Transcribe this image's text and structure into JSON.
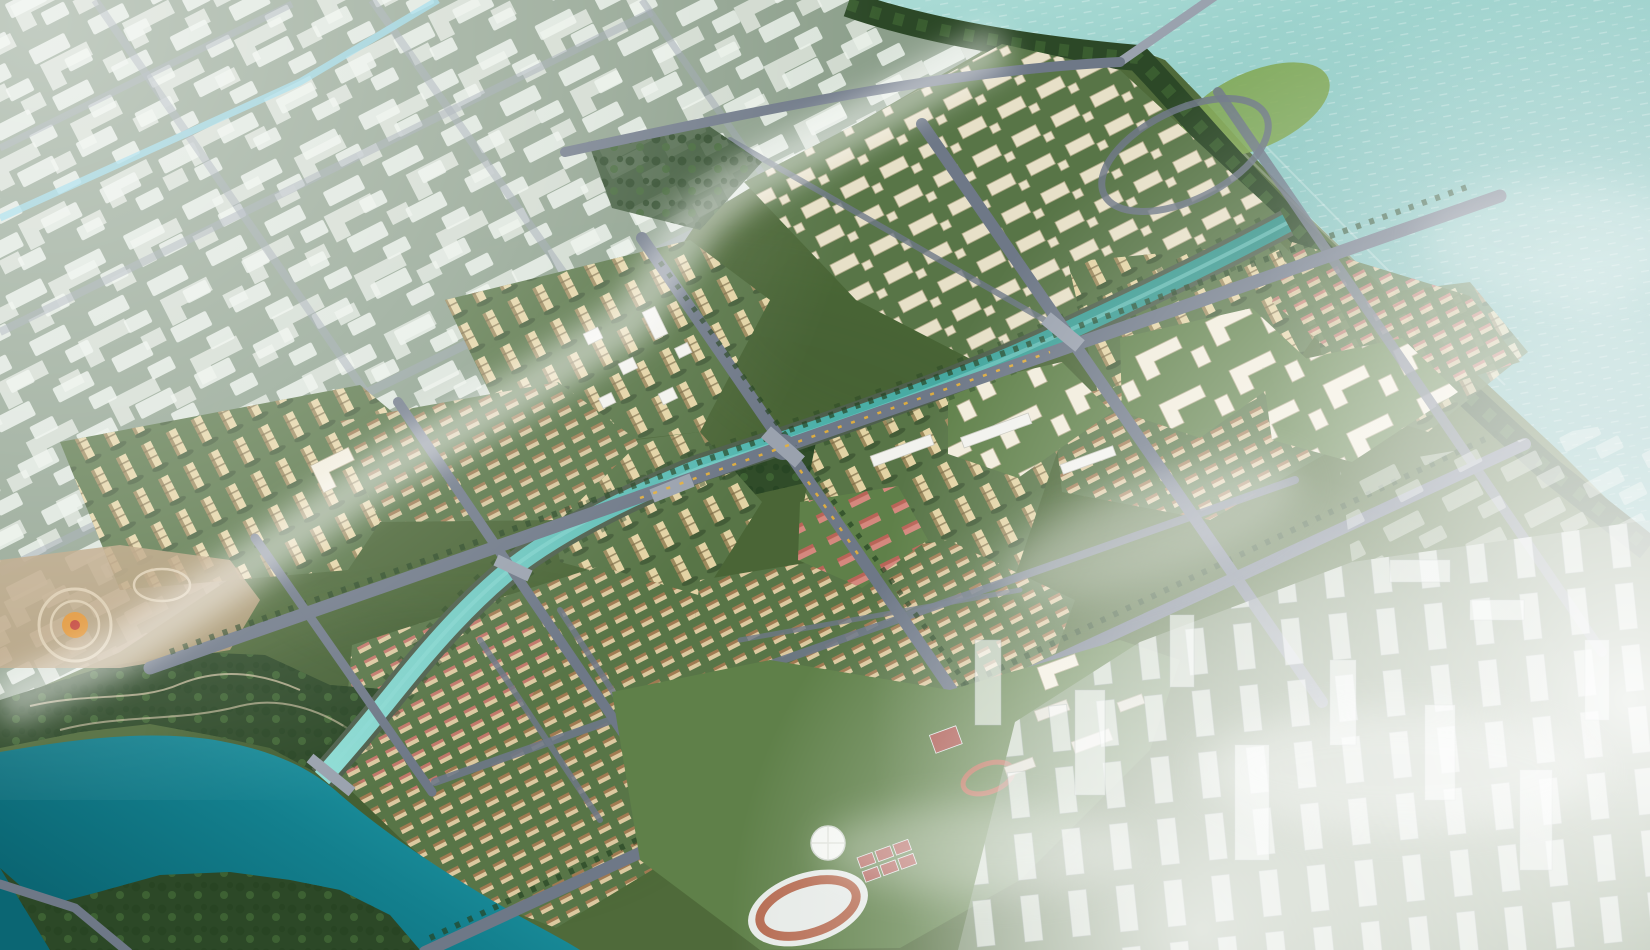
{
  "meta": {
    "title": "Aerial rendering of a waterfront urban master plan",
    "description": "Bird's-eye architectural visualization: a fully rendered residential district with gold high-rise clusters, villa rows, canals and a boulevard grid occupies the center; a ghosted white future-phase block district fades out at the upper left; a teal sea with a causeway bridge lies at the upper right behind a coastal tree belt; a winding river with forest park and a circular plaza garden sits at the lower left; a sports campus with stadium, dome and courts sits at the bottom center; ghosted CBD towers dissolve into white fog at the lower right."
  },
  "features": [
    "sea-with-sparkle",
    "coastal-tree-belt",
    "causeway-bridge",
    "lawn-hill",
    "ghost-phase-district",
    "ghost-district-canal",
    "central-canal",
    "winding-river",
    "riverside-forest-park",
    "circular-plaza-garden",
    "tower-clusters",
    "courtyard-lowrise-district",
    "villa-rows",
    "townhouse-rows",
    "school-campuses",
    "pink-school-buildings",
    "white-commercial-midrises",
    "sports-campus",
    "stadium-running-track",
    "geodesic-dome",
    "tennis-courts",
    "ghost-cbd-towers",
    "boulevard-grid-with-tree-lines",
    "fog-and-haze"
  ],
  "colors": {
    "seaLight": "#aadbd5",
    "seaMid": "#86c4bf",
    "seaDeep": "#6fb0ad",
    "riverLight": "#2aa8b4",
    "riverMid": "#13808e",
    "riverDeep": "#0b6673",
    "canalLight": "#8fdcd4",
    "canalMid": "#4fb3ac",
    "canalDark": "#2f8f85",
    "bank": "#4e5f4c",
    "landBase": "#4f6a3a",
    "landMid": "#587547",
    "lawnLight": "#7fa653",
    "lawnMid": "#5f8049",
    "parkDark": "#2c4827",
    "treeDark": "#274423",
    "treeMid": "#3f6434",
    "road": "#6e7887",
    "roadLight": "#9aa2ae",
    "roadGhost": "#97a1ab",
    "ghostGround": "#92a595",
    "ghostBlock": "#edf3ec",
    "towerFace": "#e3d3a4",
    "towerSide": "#9d8a5d",
    "towerBand": "#7a6a45",
    "towerShadow": "#24381f",
    "lowriseFace": "#e7e0c8",
    "lowriseEdge": "#b3aa8a",
    "villaFace": "#dcc9a0",
    "villaRoof": "#a17a52",
    "villaRoofPink": "#c2766a",
    "campusWhite": "#f1ecdb",
    "pinkBlock": "#d5887e",
    "pinkRoof": "#b96458",
    "trackRed": "#b56a50",
    "courtRed": "#a9544b",
    "courtLine": "#e3e8ea",
    "domeWhite": "#f3f5f1",
    "plazaTan": "#b79d79",
    "pathTan": "#d9c9ab",
    "flowerOrange": "#e0912f",
    "flowerRed": "#c03a2e",
    "busYellow": "#e8b13a",
    "whiteBldg": "#f2f2ee",
    "whiteBldgEdge": "#c6c6bc",
    "ghostTowerFill": "rgba(250,253,252,0.6)",
    "ghostTowerEdge": "rgba(150,165,160,0.45)",
    "hazeCanal": "#8fd4e6",
    "fogWhite": "#ffffff"
  }
}
